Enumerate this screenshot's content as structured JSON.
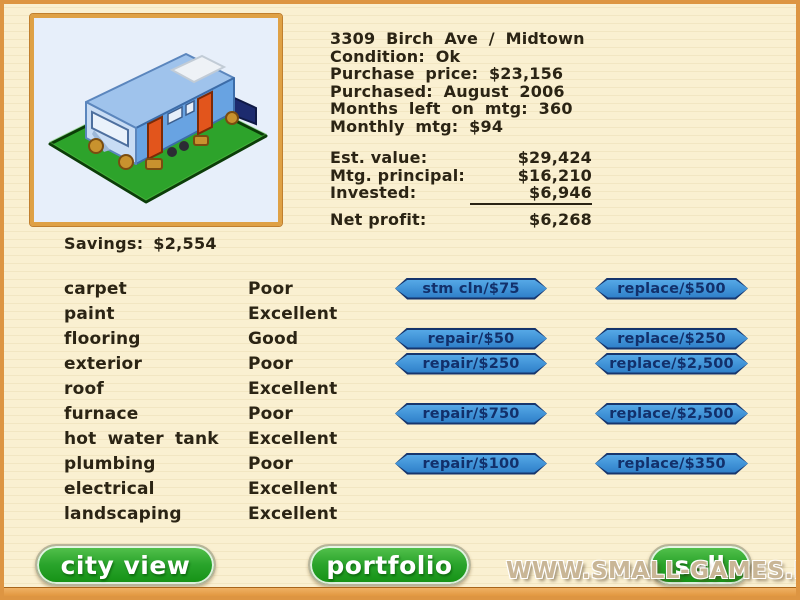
{
  "property": {
    "info_lines": [
      "3309 Birch Ave / Midtown",
      "Condition: Ok",
      "Purchase price: $23,156",
      "Purchased: August 2006",
      "Months left on mtg: 360",
      "Monthly mtg: $94"
    ],
    "financials": [
      {
        "label": "Est. value:",
        "value": "$29,424"
      },
      {
        "label": "Mtg. principal:",
        "value": "$16,210"
      },
      {
        "label": "Invested:",
        "value": "$6,946"
      },
      {
        "label": "Net profit:",
        "value": "$6,268"
      }
    ],
    "savings": "Savings: $2,554"
  },
  "components": [
    {
      "name": "carpet",
      "condition": "Poor",
      "action1": "stm cln/$75",
      "action2": "replace/$500"
    },
    {
      "name": "paint",
      "condition": "Excellent",
      "action1": "",
      "action2": ""
    },
    {
      "name": "flooring",
      "condition": "Good",
      "action1": "repair/$50",
      "action2": "replace/$250"
    },
    {
      "name": "exterior",
      "condition": "Poor",
      "action1": "repair/$250",
      "action2": "replace/$2,500"
    },
    {
      "name": "roof",
      "condition": "Excellent",
      "action1": "",
      "action2": ""
    },
    {
      "name": "furnace",
      "condition": "Poor",
      "action1": "repair/$750",
      "action2": "replace/$2,500"
    },
    {
      "name": "hot water tank",
      "condition": "Excellent",
      "action1": "",
      "action2": ""
    },
    {
      "name": "plumbing",
      "condition": "Poor",
      "action1": "repair/$100",
      "action2": "replace/$350"
    },
    {
      "name": "electrical",
      "condition": "Excellent",
      "action1": "",
      "action2": ""
    },
    {
      "name": "landscaping",
      "condition": "Excellent",
      "action1": "",
      "action2": ""
    }
  ],
  "nav_buttons": {
    "city_view": "city view",
    "portfolio": "portfolio",
    "sell": "sell"
  },
  "watermark": "WWW.SMALL-GAMES.INFO",
  "colors": {
    "background": "#faf0d1",
    "frame_orange": "#dd9542",
    "action_button_blue": "#3f93d8",
    "action_button_navy": "#16356d",
    "nav_button_green": "#2aa42c",
    "text_dark": "#2b2414"
  }
}
